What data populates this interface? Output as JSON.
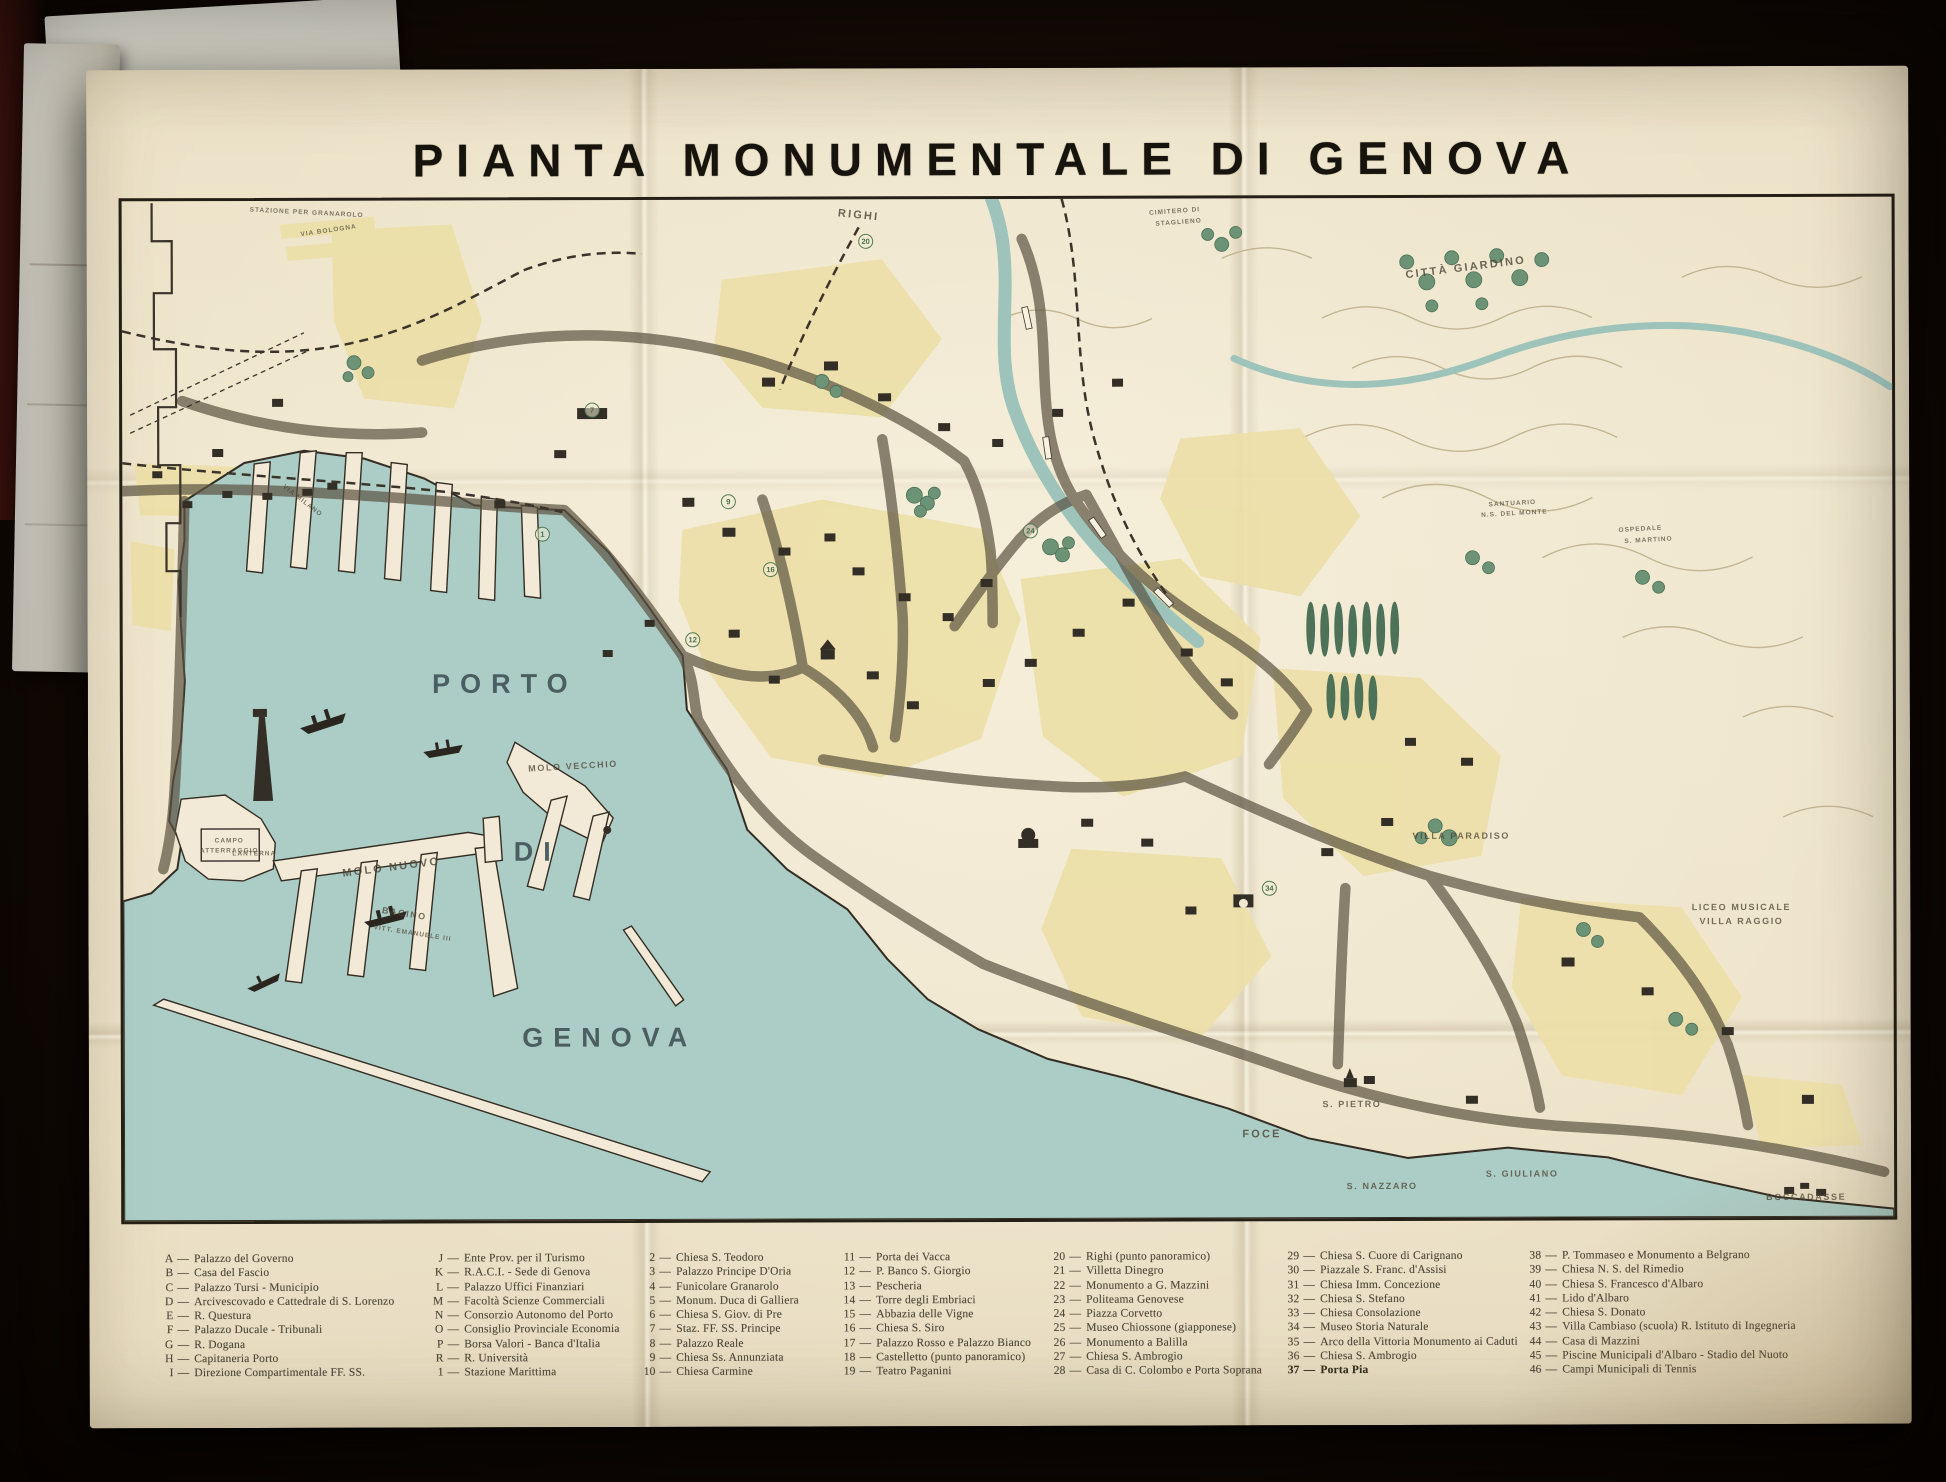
{
  "title": "PIANTA MONUMENTALE DI GENOVA",
  "colors": {
    "paper": "#efe5cc",
    "water": "#accdc6",
    "city_block_yellow": "#ecdfa7",
    "park_green": "#6d9377",
    "ink": "#2f2a22",
    "big_label_teal": "#43565b",
    "background": "#160d07"
  },
  "map_labels": [
    {
      "text": "PORTO",
      "x": 382,
      "y": 484,
      "cls": "xl",
      "rot": 0
    },
    {
      "text": "DI",
      "x": 414,
      "y": 652,
      "cls": "xl",
      "rot": 0
    },
    {
      "text": "GENOVA",
      "x": 486,
      "y": 838,
      "cls": "xl",
      "rot": 0
    },
    {
      "text": "MOLO NUOVO",
      "x": 268,
      "y": 667,
      "cls": "sm",
      "rot": -7
    },
    {
      "text": "BACINO",
      "x": 281,
      "y": 713,
      "cls": "xs",
      "rot": 9
    },
    {
      "text": "VITT. EMANUELE III",
      "x": 289,
      "y": 733,
      "cls": "xxs",
      "rot": 9
    },
    {
      "text": "MOLO VECCHIO",
      "x": 450,
      "y": 566,
      "cls": "xs",
      "rot": -3
    },
    {
      "text": "LANTERNA",
      "x": 131,
      "y": 653,
      "cls": "xxs",
      "rot": 0
    },
    {
      "text": "CAMPO",
      "x": 106,
      "y": 640,
      "cls": "xxs",
      "rot": 0
    },
    {
      "text": "ATTERRAGGIO",
      "x": 106,
      "y": 650,
      "cls": "xxs",
      "rot": 0
    },
    {
      "text": "VIA MILANO",
      "x": 180,
      "y": 300,
      "cls": "xxs",
      "rot": 38
    },
    {
      "text": "VIA BOLOGNA",
      "x": 207,
      "y": 30,
      "cls": "xxs",
      "rot": -8
    },
    {
      "text": "STAZIONE PER GRANAROLO",
      "x": 185,
      "y": 12,
      "cls": "xxs",
      "rot": 3
    },
    {
      "text": "RIGHI",
      "x": 737,
      "y": 16,
      "cls": "sm",
      "rot": 6
    },
    {
      "text": "CIMITERO DI",
      "x": 1053,
      "y": 13,
      "cls": "xxs",
      "rot": -4
    },
    {
      "text": "STAGLIENO",
      "x": 1057,
      "y": 24,
      "cls": "xxs",
      "rot": -4
    },
    {
      "text": "CITTÀ GIARDINO",
      "x": 1344,
      "y": 70,
      "cls": "sm",
      "rot": -7
    },
    {
      "text": "SANTUARIO",
      "x": 1390,
      "y": 306,
      "cls": "xxs",
      "rot": -3
    },
    {
      "text": "N.S. DEL MONTE",
      "x": 1392,
      "y": 316,
      "cls": "xxs",
      "rot": -3
    },
    {
      "text": "OSPEDALE",
      "x": 1518,
      "y": 332,
      "cls": "xxs",
      "rot": -3
    },
    {
      "text": "S. MARTINO",
      "x": 1526,
      "y": 343,
      "cls": "xxs",
      "rot": -3
    },
    {
      "text": "VILLA PARADISO",
      "x": 1338,
      "y": 638,
      "cls": "xs",
      "rot": 0
    },
    {
      "text": "LICEO MUSICALE",
      "x": 1618,
      "y": 710,
      "cls": "xs",
      "rot": 0
    },
    {
      "text": "VILLA RAGGIO",
      "x": 1618,
      "y": 724,
      "cls": "xs",
      "rot": 0
    },
    {
      "text": "FOCE",
      "x": 1138,
      "y": 936,
      "cls": "sm",
      "rot": 0
    },
    {
      "text": "S. PIETRO",
      "x": 1228,
      "y": 906,
      "cls": "xs",
      "rot": 0
    },
    {
      "text": "S. NAZZARO",
      "x": 1258,
      "y": 988,
      "cls": "xs",
      "rot": 0
    },
    {
      "text": "S. GIULIANO",
      "x": 1398,
      "y": 976,
      "cls": "xs",
      "rot": 0
    },
    {
      "text": "BOCCADASSE",
      "x": 1682,
      "y": 1000,
      "cls": "xs",
      "rot": 0
    }
  ],
  "map_markers": [
    {
      "n": "7",
      "x": 470,
      "y": 210
    },
    {
      "n": "1",
      "x": 420,
      "y": 334
    },
    {
      "n": "9",
      "x": 606,
      "y": 302
    },
    {
      "n": "16",
      "x": 648,
      "y": 370
    },
    {
      "n": "12",
      "x": 570,
      "y": 440
    },
    {
      "n": "24",
      "x": 908,
      "y": 332
    },
    {
      "n": "20",
      "x": 744,
      "y": 42
    },
    {
      "n": "34",
      "x": 1146,
      "y": 690
    }
  ],
  "legend": {
    "columns": [
      {
        "entries": [
          {
            "key": "A",
            "text": "Palazzo del Governo"
          },
          {
            "key": "B",
            "text": "Casa del Fascio"
          },
          {
            "key": "C",
            "text": "Palazzo Tursi - Municipio"
          },
          {
            "key": "D",
            "text": "Arcivescovado e Cattedrale di S. Lorenzo"
          },
          {
            "key": "E",
            "text": "R. Questura"
          },
          {
            "key": "F",
            "text": "Palazzo Ducale - Tribunali"
          },
          {
            "key": "G",
            "text": "R. Dogana"
          },
          {
            "key": "H",
            "text": "Capitaneria Porto"
          },
          {
            "key": "I",
            "text": "Direzione Compartimentale FF. SS."
          }
        ]
      },
      {
        "entries": [
          {
            "key": "J",
            "text": "Ente Prov. per il Turismo"
          },
          {
            "key": "K",
            "text": "R.A.C.I. - Sede di Genova"
          },
          {
            "key": "L",
            "text": "Palazzo Uffici Finanziari"
          },
          {
            "key": "M",
            "text": "Facoltà Scienze Commerciali"
          },
          {
            "key": "N",
            "text": "Consorzio Autonomo del Porto"
          },
          {
            "key": "O",
            "text": "Consiglio Provinciale Economia"
          },
          {
            "key": "P",
            "text": "Borsa Valori - Banca d'Italia"
          },
          {
            "key": "R",
            "text": "R. Università"
          },
          {
            "key": "1",
            "text": "Stazione Marittima"
          }
        ]
      },
      {
        "entries": [
          {
            "key": "2",
            "text": "Chiesa S. Teodoro"
          },
          {
            "key": "3",
            "text": "Palazzo Principe D'Oria"
          },
          {
            "key": "4",
            "text": "Funicolare Granarolo"
          },
          {
            "key": "5",
            "text": "Monum. Duca di Galliera"
          },
          {
            "key": "6",
            "text": "Chiesa S. Giov. di Pre"
          },
          {
            "key": "7",
            "text": "Staz. FF. SS. Principe"
          },
          {
            "key": "8",
            "text": "Palazzo Reale"
          },
          {
            "key": "9",
            "text": "Chiesa Ss. Annunziata"
          },
          {
            "key": "10",
            "text": "Chiesa Carmine"
          }
        ]
      },
      {
        "entries": [
          {
            "key": "11",
            "text": "Porta dei Vacca"
          },
          {
            "key": "12",
            "text": "P. Banco S. Giorgio"
          },
          {
            "key": "13",
            "text": "Pescheria"
          },
          {
            "key": "14",
            "text": "Torre degli Embriaci"
          },
          {
            "key": "15",
            "text": "Abbazia delle Vigne"
          },
          {
            "key": "16",
            "text": "Chiesa S. Siro"
          },
          {
            "key": "17",
            "text": "Palazzo Rosso e Palazzo Bianco"
          },
          {
            "key": "18",
            "text": "Castelletto (punto panoramico)"
          },
          {
            "key": "19",
            "text": "Teatro Paganini"
          }
        ]
      },
      {
        "entries": [
          {
            "key": "20",
            "text": "Righi (punto panoramico)"
          },
          {
            "key": "21",
            "text": "Villetta Dinegro"
          },
          {
            "key": "22",
            "text": "Monumento a G. Mazzini"
          },
          {
            "key": "23",
            "text": "Politeama Genovese"
          },
          {
            "key": "24",
            "text": "Piazza Corvetto"
          },
          {
            "key": "25",
            "text": "Museo Chiossone (giapponese)"
          },
          {
            "key": "26",
            "text": "Monumento a Balilla"
          },
          {
            "key": "27",
            "text": "Chiesa S. Ambrogio"
          },
          {
            "key": "28",
            "text": "Casa di C. Colombo e Porta Soprana"
          }
        ]
      },
      {
        "entries": [
          {
            "key": "29",
            "text": "Chiesa S. Cuore di Carignano"
          },
          {
            "key": "30",
            "text": "Piazzale S. Franc. d'Assisi"
          },
          {
            "key": "31",
            "text": "Chiesa Imm. Concezione"
          },
          {
            "key": "32",
            "text": "Chiesa S. Stefano"
          },
          {
            "key": "33",
            "text": "Chiesa Consolazione"
          },
          {
            "key": "34",
            "text": "Museo Storia Naturale"
          },
          {
            "key": "35",
            "text": "Arco della Vittoria Monumento ai Caduti"
          },
          {
            "key": "36",
            "text": "Chiesa S. Ambrogio"
          },
          {
            "key": "37",
            "text": "Porta Pia",
            "bold": true
          }
        ]
      },
      {
        "entries": [
          {
            "key": "38",
            "text": "P. Tommaseo e Monumento a Belgrano"
          },
          {
            "key": "39",
            "text": "Chiesa N. S. del Rimedio"
          },
          {
            "key": "40",
            "text": "Chiesa S. Francesco d'Albaro"
          },
          {
            "key": "41",
            "text": "Lido d'Albaro"
          },
          {
            "key": "42",
            "text": "Chiesa S. Donato"
          },
          {
            "key": "43",
            "text": "Villa Cambiaso (scuola) R. Istituto di Ingegneria"
          },
          {
            "key": "44",
            "text": "Casa di Mazzini"
          },
          {
            "key": "45",
            "text": "Piscine Municipali d'Albaro - Stadio del Nuoto"
          },
          {
            "key": "46",
            "text": "Campi Municipali di Tennis"
          }
        ]
      }
    ]
  }
}
